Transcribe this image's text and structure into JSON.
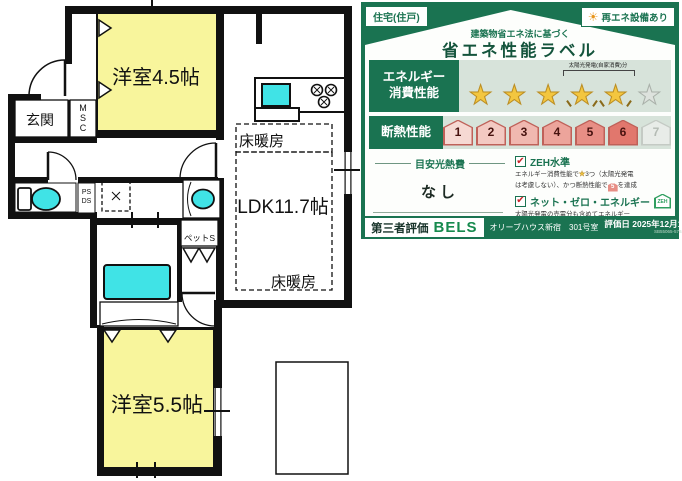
{
  "floor_plan": {
    "rooms": {
      "room1": "洋室4.5帖",
      "room2": "洋室5.5帖",
      "ldk": "LDK11.7帖",
      "genkan": "玄関",
      "floor_heating_1": "床暖房",
      "floor_heating_2": "床暖房",
      "pet_space": "ペットS"
    },
    "msc_letters": [
      "M",
      "S",
      "C"
    ],
    "ps_ds": [
      "PS",
      "DS"
    ],
    "colors": {
      "room_fill": "#f8f59c",
      "fixture_fill": "#40e3e6",
      "wall": "#111111"
    }
  },
  "energy_label": {
    "housing_type_badge": "住宅(住戸)",
    "renewable_badge": "再エネ設備あり",
    "subtitle": "建築物省エネ法に基づく",
    "title": "省エネ性能ラベル",
    "energy_row": {
      "label_line1": "エネルギー",
      "label_line2": "消費性能",
      "star_glyph": "★",
      "filled_stars": 3,
      "solar_stars": 2,
      "empty_stars": 1,
      "solar_note": "太陽光発電(自家消費)分"
    },
    "insulation_row": {
      "label": "断熱性能",
      "grades": [
        "1",
        "2",
        "3",
        "4",
        "5",
        "6",
        "7"
      ],
      "achieved_grade": 6
    },
    "cost_section": {
      "heading": "目安光熱費",
      "value": "なし"
    },
    "zeh_section": {
      "check_glyph": "✔",
      "item1_title": "ZEH水準",
      "item1_note_l1a": "エネルギー消費性能で",
      "item1_note_star": "★",
      "item1_note_l1b": "3つ（太陽光発電",
      "item1_note_l2a": "は考慮しない）、かつ断熱性能で",
      "item1_note_house": "5",
      "item1_note_l2b": "を達成",
      "item2_title": "ネット・ゼロ・エネルギー",
      "item2_badge": "ZEH",
      "item2_note_l1": "太陽光発電の売電分も含めてエネルギー",
      "item2_note_l2": "収支がゼロ以下を達成"
    },
    "footer": {
      "evaluator_label": "第三者評価",
      "evaluator_name": "BELS",
      "property": "オリーブハウス新宿　301号室",
      "eval_date": "評価日 2025年12月10日",
      "ref_number": "SB55065-5784-4971"
    },
    "colors": {
      "green": "#1a7351",
      "star_gold": "#f3c63f",
      "row_bg": "#d7e3da"
    }
  }
}
